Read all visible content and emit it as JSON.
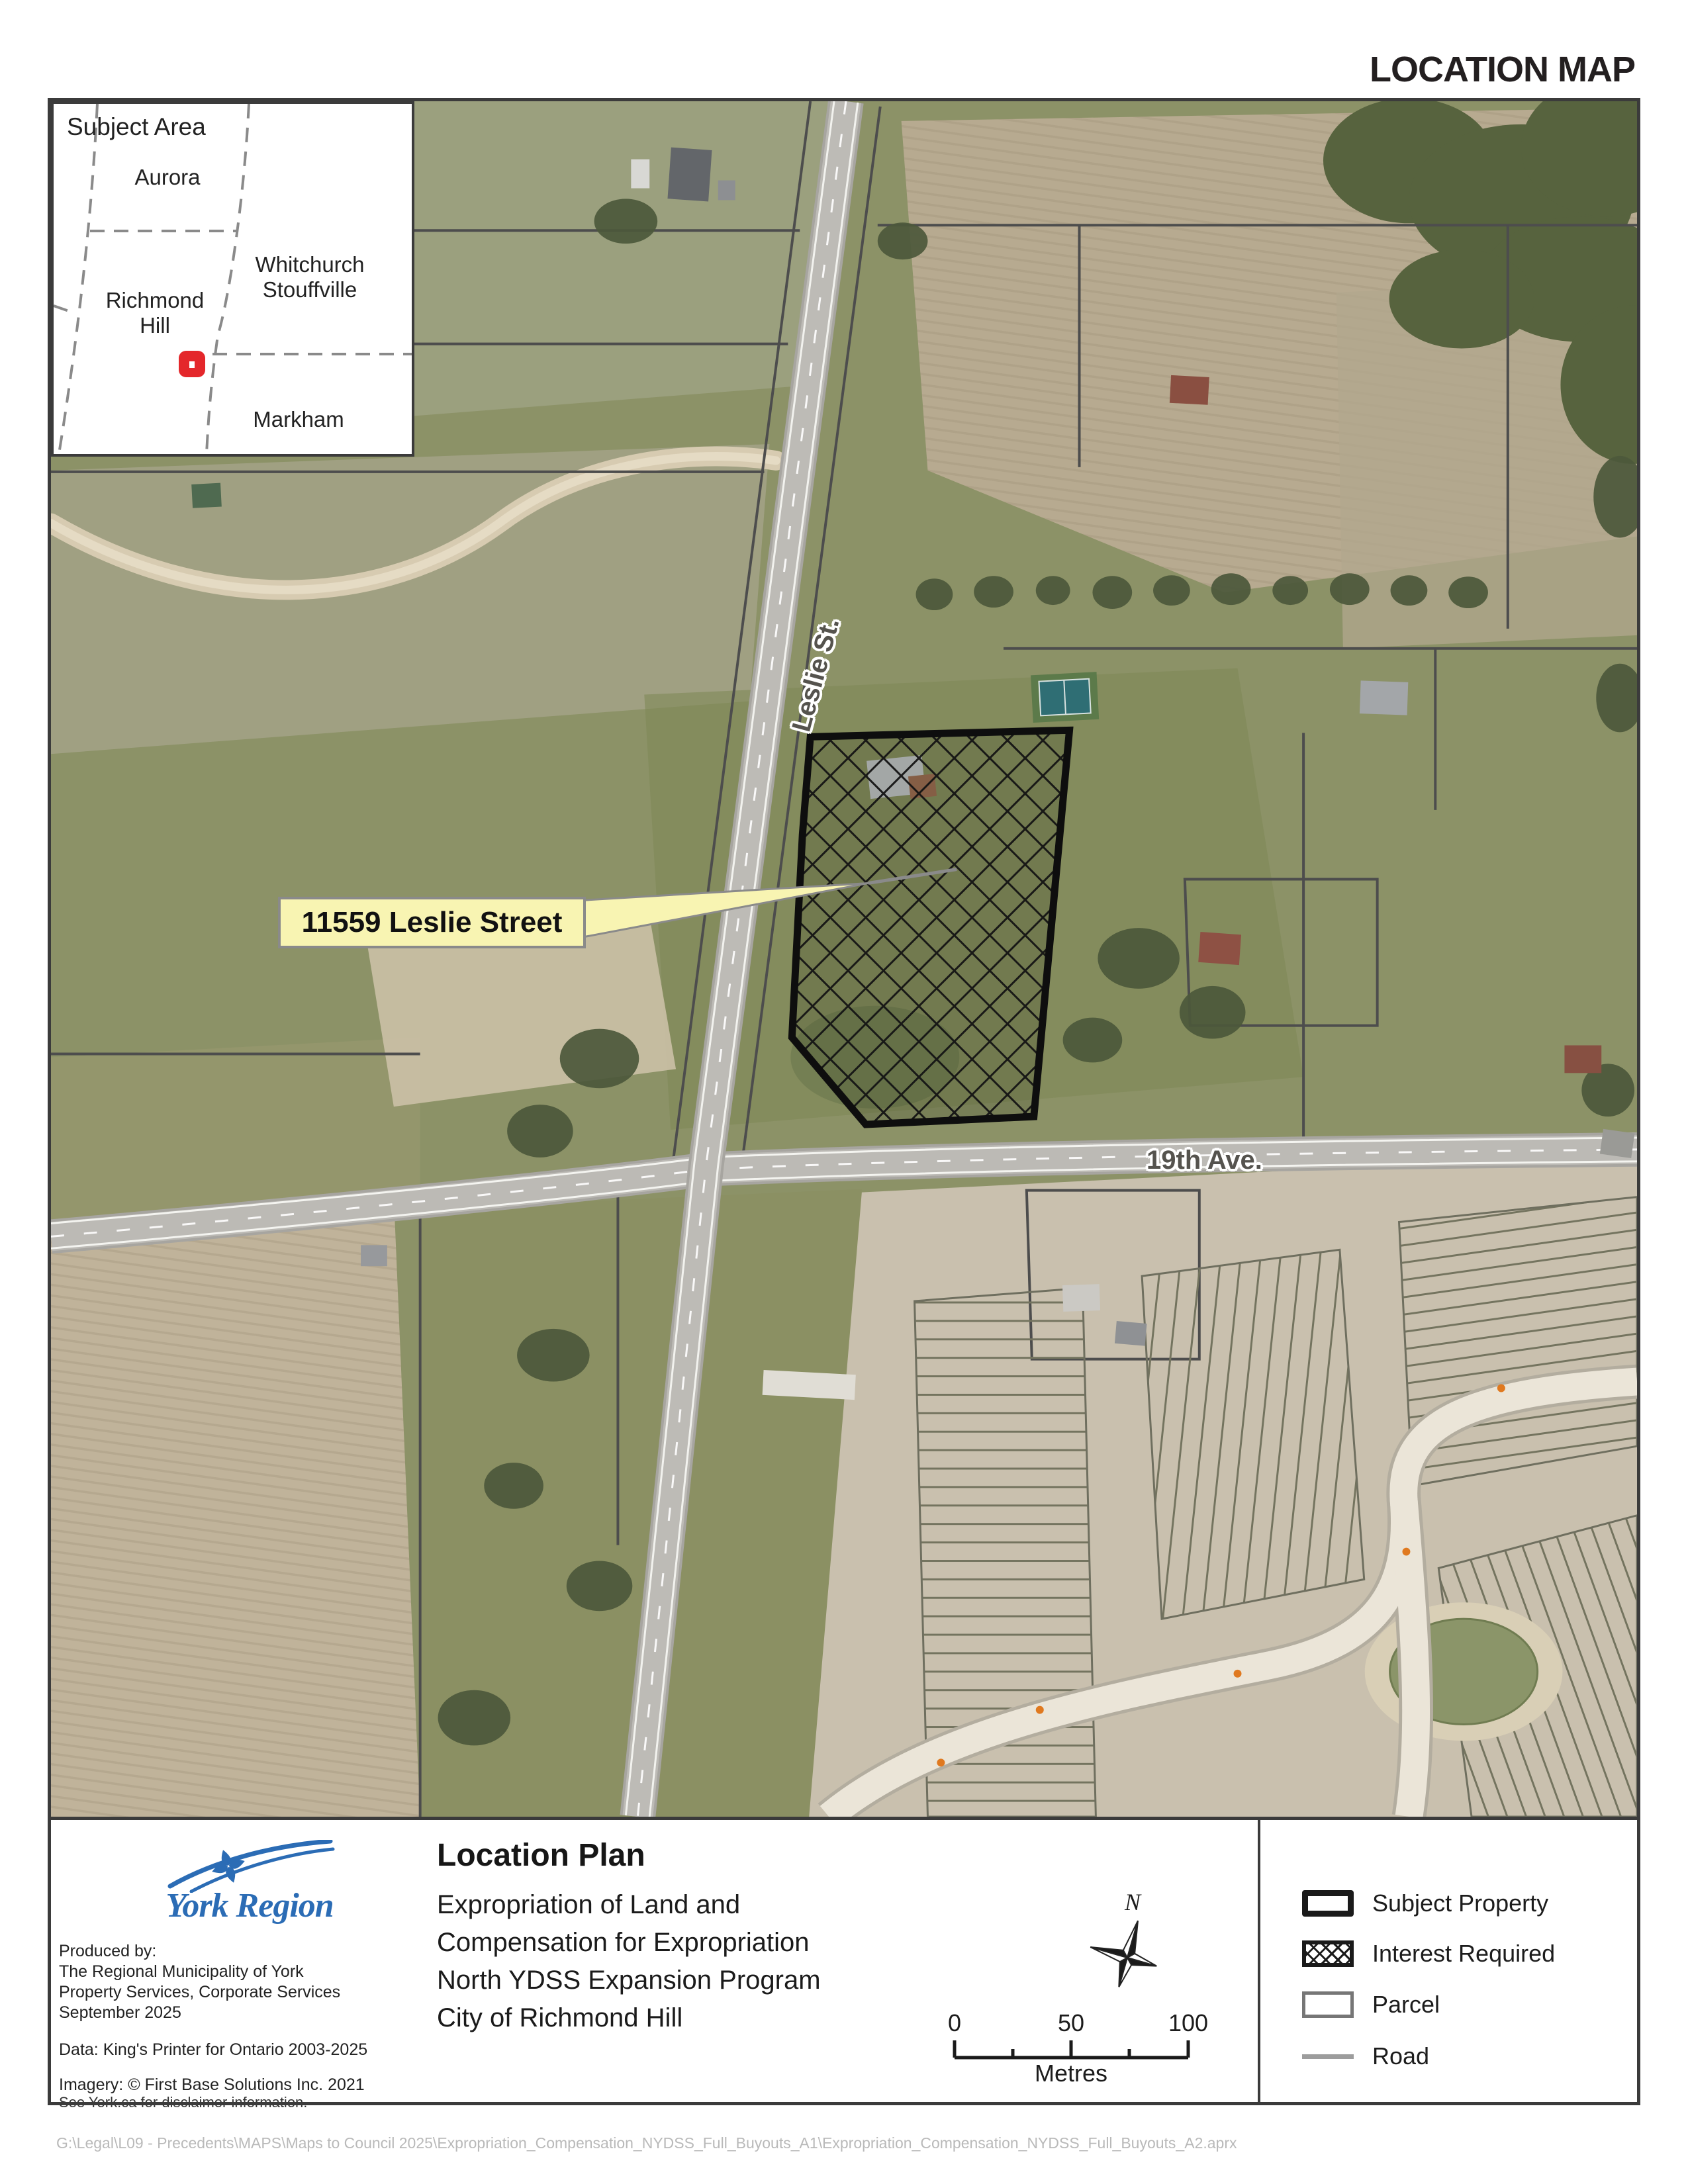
{
  "header": {
    "title": "LOCATION MAP"
  },
  "inset": {
    "title": "Subject Area",
    "regions": {
      "aurora": "Aurora",
      "whitchurch_line1": "Whitchurch",
      "whitchurch_line2": "Stouffville",
      "richmond_line1": "Richmond",
      "richmond_line2": "Hill",
      "markham": "Markham"
    }
  },
  "map": {
    "road_labels": {
      "leslie": "Leslie St.",
      "nineteenth": "19th Ave."
    },
    "callout": {
      "label": "11559 Leslie Street"
    }
  },
  "panel": {
    "producer": {
      "logo_text": "York Region",
      "produced_by": [
        "Produced by:",
        "The Regional Municipality of York",
        "Property Services, Corporate Services",
        "September 2025"
      ],
      "data_credit": "Data: King's Printer for Ontario 2003-2025",
      "imagery_credit": "Imagery: © First Base Solutions Inc. 2021",
      "disclaimer": "See York.ca for disclaimer information."
    },
    "title_block": {
      "title": "Location Plan",
      "subtitle": [
        "Expropriation of Land and",
        "Compensation for Expropriation",
        "North YDSS Expansion Program",
        "City of Richmond Hill"
      ]
    },
    "north_label": "N",
    "scale_bar": {
      "labels": [
        "0",
        "50",
        "100"
      ],
      "unit": "Metres"
    },
    "legend": {
      "items": [
        "Subject Property",
        "Interest Required",
        "Parcel",
        "Road"
      ]
    }
  },
  "footer": {
    "path": "G:\\Legal\\L09 - Precedents\\MAPS\\Maps to Council 2025\\Expropriation_Compensation_NYDSS_Full_Buyouts_A1\\Expropriation_Compensation_NYDSS_Full_Buyouts_A2.aprx"
  },
  "colors": {
    "accent_blue": "#2b6cb5",
    "marker_red": "#e4272b",
    "callout_yellow": "#f8f4b2"
  }
}
